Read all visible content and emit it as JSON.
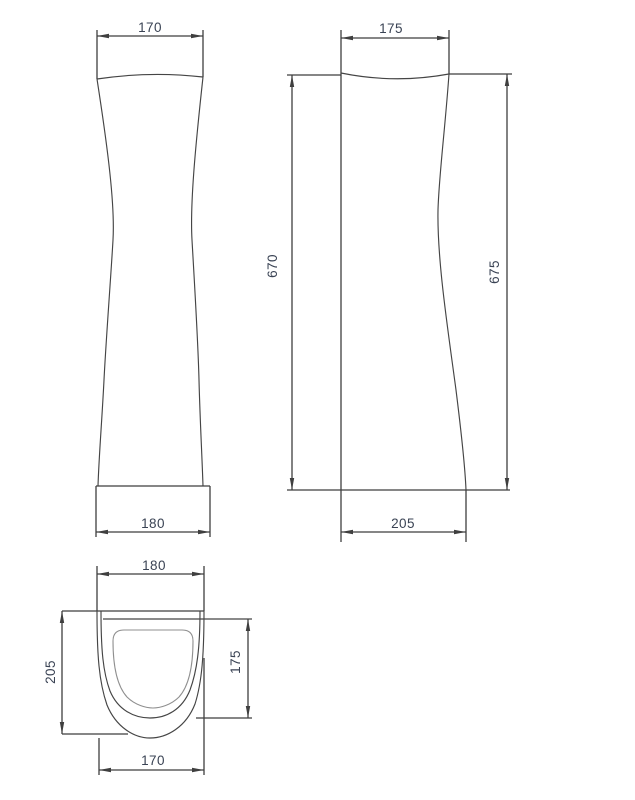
{
  "drawing": {
    "colors": {
      "background": "#ffffff",
      "line": "#3f3f3f",
      "light_line": "#8f8f8f",
      "text": "#3a4354"
    },
    "views": {
      "front": {
        "dim_top_width": "170",
        "dim_bottom_width": "180"
      },
      "side": {
        "dim_top_width": "175",
        "dim_left_height": "670",
        "dim_right_height": "675",
        "dim_bottom_depth": "205"
      },
      "plan": {
        "dim_top_width": "180",
        "dim_left_depth": "205",
        "dim_right_depth": "175",
        "dim_bottom_width": "170"
      }
    }
  }
}
